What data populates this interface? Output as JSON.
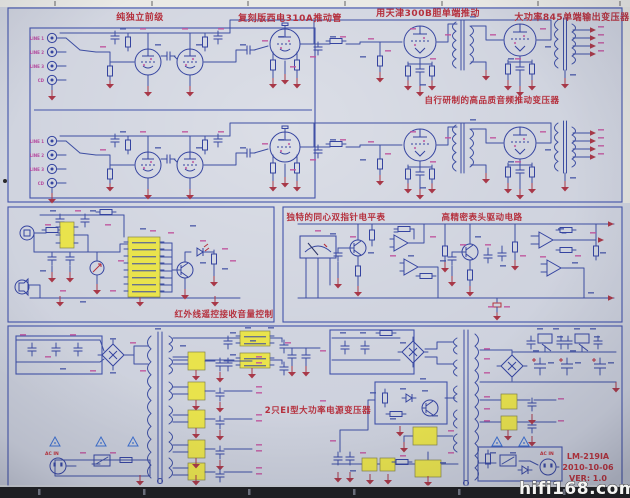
{
  "colors": {
    "paper": "#ccd0dc",
    "wire_blue": "#3d4ea2",
    "label_red": "#b5303d",
    "component_magenta": "#c0569e",
    "ic_yellow": "#e9e34c",
    "bottom_strip": "#1e1f23"
  },
  "sections": {
    "preamp": "纯独立前级",
    "driver_tube": "复刻版西电310A推动管",
    "power_drive": "用天津300B胆单端推动",
    "output_transformer": "大功率845单端输出变压器",
    "interstage_transformer": "自行研制的高品质音频推动变压器",
    "vu_meter": "独特的同心双指针电平表",
    "meter_driver": "高精密表头驱动电路",
    "remote_volume": "红外线遥控接收音量控制",
    "power_transformer": "2只EI型大功率电源变压器"
  },
  "inputs": {
    "jacks": [
      "LINE 1",
      "LINE 2",
      "LINE 3",
      "CD"
    ]
  },
  "power": {
    "ac_in": "AC IN"
  },
  "title_block": {
    "model": "LM-219IA",
    "date": "2010-10-06",
    "version": "VER: 1.0"
  },
  "watermark": "hifi168.com"
}
